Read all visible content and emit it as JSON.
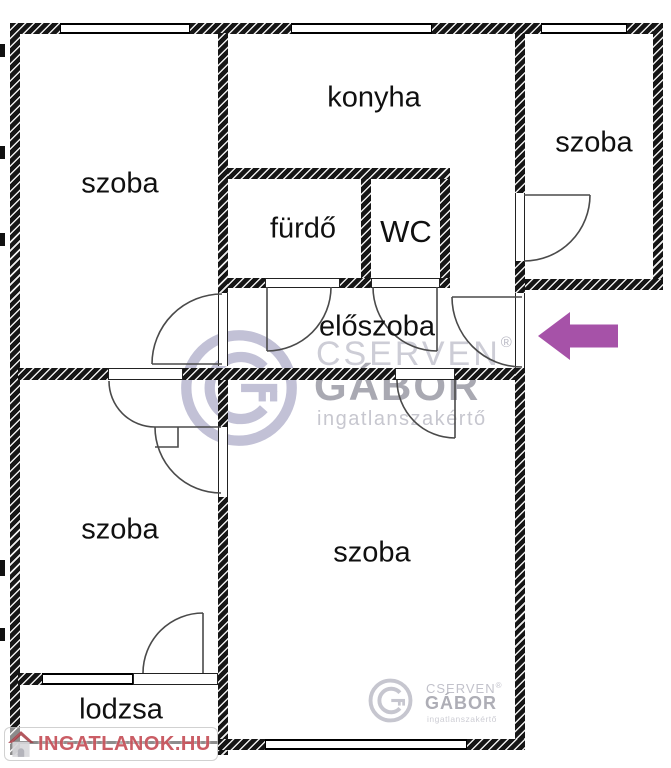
{
  "rooms": {
    "top_left": {
      "label": "szoba"
    },
    "kitchen": {
      "label": "konyha"
    },
    "bathroom": {
      "label": "fürdő"
    },
    "wc": {
      "label": "WC"
    },
    "top_right": {
      "label": "szoba"
    },
    "hallway": {
      "label": "előszoba"
    },
    "bottom_left": {
      "label": "szoba"
    },
    "living": {
      "label": "szoba"
    },
    "loggia": {
      "label": "lodzsa"
    }
  },
  "watermarks": {
    "agency": {
      "name_line1": "CSERVEN",
      "registered": "®",
      "name_line2": "GÁBOR",
      "tagline": "ingatlanszakértő"
    },
    "portal": {
      "text": "INGATLANOK.HU"
    }
  },
  "icons": {
    "entrance_arrow": "left-arrow",
    "agency_logo": "g-key-in-circle",
    "portal_logo": "house-icon"
  },
  "colors": {
    "wall": "#161616",
    "arrow_purple": "#a652a8",
    "watermark_lavender": "#c2c1d6",
    "watermark_gray": "#aeaeb6",
    "portal_red": "#c1414a"
  }
}
